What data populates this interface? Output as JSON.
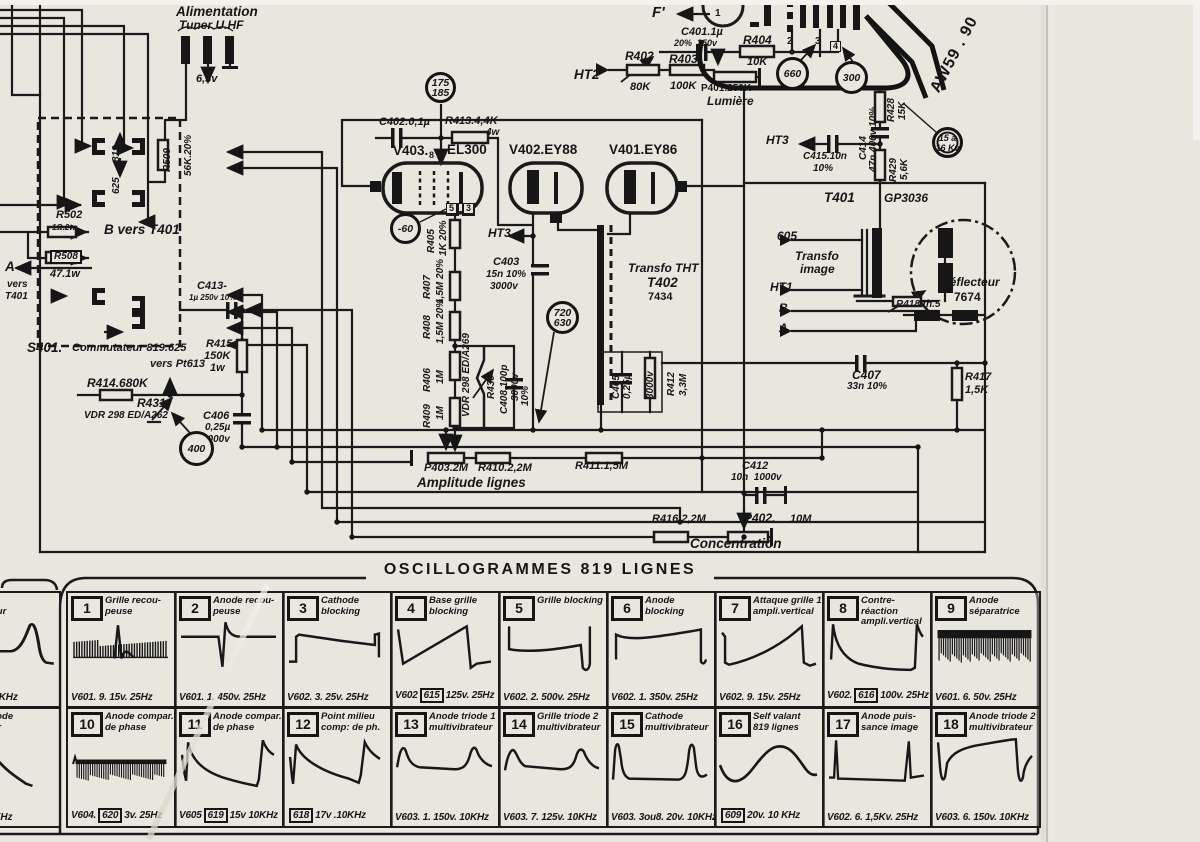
{
  "meta": {
    "paper_color": "#e9e6de",
    "ink_color": "#1a1a1a"
  },
  "schematic": {
    "labels": [
      {
        "t": "Alimentation",
        "x": 176,
        "y": 5,
        "c": "s13"
      },
      {
        "t": "Tuner U.HF",
        "x": 179,
        "y": 19,
        "c": "s12"
      },
      {
        "t": "6,3v",
        "x": 196,
        "y": 74,
        "c": "s11"
      },
      {
        "t": "R502",
        "x": 56,
        "y": 210,
        "c": "s11"
      },
      {
        "t": "1Ω.2w",
        "x": 52,
        "y": 224,
        "c": "s8"
      },
      {
        "t": "B vers T401",
        "x": 104,
        "y": 223,
        "c": "s13"
      },
      {
        "t": "R508",
        "x": 50,
        "y": 250,
        "c": "s10 boxed"
      },
      {
        "t": "47.1w",
        "x": 50,
        "y": 269,
        "c": "s11"
      },
      {
        "t": "A",
        "x": 5,
        "y": 260,
        "c": "s13"
      },
      {
        "t": "vers",
        "x": 7,
        "y": 280,
        "c": "s10"
      },
      {
        "t": "T401",
        "x": 5,
        "y": 292,
        "c": "s10"
      },
      {
        "t": "C413-",
        "x": 197,
        "y": 281,
        "c": "s11"
      },
      {
        "t": "1µ 250v 10%",
        "x": 189,
        "y": 294,
        "c": "s8"
      },
      {
        "t": "S401.",
        "x": 27,
        "y": 341,
        "c": "s13"
      },
      {
        "t": "Commutateur 819.625",
        "x": 72,
        "y": 343,
        "c": "s11"
      },
      {
        "t": "vers Pt613",
        "x": 150,
        "y": 359,
        "c": "s11"
      },
      {
        "t": "R414.680K",
        "x": 87,
        "y": 377,
        "c": "s12"
      },
      {
        "t": "R431",
        "x": 137,
        "y": 397,
        "c": "s12"
      },
      {
        "t": "VDR 298 ED/A262",
        "x": 84,
        "y": 411,
        "c": "s10"
      },
      {
        "t": "R415",
        "x": 206,
        "y": 339,
        "c": "s11"
      },
      {
        "t": "150K",
        "x": 204,
        "y": 351,
        "c": "s11"
      },
      {
        "t": "1w",
        "x": 210,
        "y": 363,
        "c": "s11"
      },
      {
        "t": "C406",
        "x": 203,
        "y": 411,
        "c": "s11"
      },
      {
        "t": "0,25µ",
        "x": 205,
        "y": 423,
        "c": "s10"
      },
      {
        "t": "3000v",
        "x": 202,
        "y": 435,
        "c": "s10"
      },
      {
        "t": "C402.0,1µ",
        "x": 379,
        "y": 117,
        "c": "s11"
      },
      {
        "t": "R413.4,4K",
        "x": 445,
        "y": 116,
        "c": "s11"
      },
      {
        "t": "4w",
        "x": 486,
        "y": 128,
        "c": "s10"
      },
      {
        "t": "V403.",
        "x": 393,
        "y": 144,
        "c": "s13 up"
      },
      {
        "t": "8",
        "x": 429,
        "y": 151,
        "c": "s9 up"
      },
      {
        "t": "EL300",
        "x": 447,
        "y": 143,
        "c": "s13 up"
      },
      {
        "t": "5",
        "x": 446,
        "y": 203,
        "c": "s9 pinbox"
      },
      {
        "t": "3",
        "x": 463,
        "y": 203,
        "c": "s9 pinbox"
      },
      {
        "t": "HT3",
        "x": 488,
        "y": 227,
        "c": "s12"
      },
      {
        "t": "C403",
        "x": 493,
        "y": 257,
        "c": "s11"
      },
      {
        "t": "15n 10%",
        "x": 486,
        "y": 270,
        "c": "s10"
      },
      {
        "t": "3000v",
        "x": 490,
        "y": 282,
        "c": "s10"
      },
      {
        "t": "V402.EY88",
        "x": 509,
        "y": 143,
        "c": "s13 up"
      },
      {
        "t": "V401.EY86",
        "x": 609,
        "y": 143,
        "c": "s13 up"
      },
      {
        "t": "Transfo THT",
        "x": 628,
        "y": 262,
        "c": "s12"
      },
      {
        "t": "T402",
        "x": 647,
        "y": 276,
        "c": "s13"
      },
      {
        "t": "7434",
        "x": 648,
        "y": 292,
        "c": "s11 up"
      },
      {
        "t": "C407",
        "x": 852,
        "y": 369,
        "c": "s12"
      },
      {
        "t": "33n 10%",
        "x": 847,
        "y": 382,
        "c": "s10"
      },
      {
        "t": "R417",
        "x": 965,
        "y": 372,
        "c": "s11"
      },
      {
        "t": "1,5K",
        "x": 965,
        "y": 385,
        "c": "s11"
      },
      {
        "t": "HT2",
        "x": 574,
        "y": 68,
        "c": "s13"
      },
      {
        "t": "R402",
        "x": 625,
        "y": 50,
        "c": "s12"
      },
      {
        "t": "80K",
        "x": 630,
        "y": 82,
        "c": "s11"
      },
      {
        "t": "R403",
        "x": 669,
        "y": 53,
        "c": "s12"
      },
      {
        "t": "100K",
        "x": 670,
        "y": 81,
        "c": "s11"
      },
      {
        "t": "P401.250K",
        "x": 701,
        "y": 84,
        "c": "s10 up"
      },
      {
        "t": "Lumière",
        "x": 707,
        "y": 95,
        "c": "s12"
      },
      {
        "t": "C401.1µ",
        "x": 681,
        "y": 27,
        "c": "s11"
      },
      {
        "t": "20%  250v",
        "x": 674,
        "y": 39,
        "c": "s9"
      },
      {
        "t": "R404",
        "x": 743,
        "y": 34,
        "c": "s12"
      },
      {
        "t": "10K",
        "x": 747,
        "y": 57,
        "c": "s11"
      },
      {
        "t": "F'",
        "x": 652,
        "y": 5,
        "c": "s14"
      },
      {
        "t": "1",
        "x": 715,
        "y": 9,
        "c": "s10 up"
      },
      {
        "t": "2",
        "x": 787,
        "y": 37,
        "c": "s10 up"
      },
      {
        "t": "3",
        "x": 815,
        "y": 37,
        "c": "s10 up"
      },
      {
        "t": "4",
        "x": 830,
        "y": 41,
        "c": "s9 pinbox"
      },
      {
        "t": "HT3",
        "x": 766,
        "y": 134,
        "c": "s12"
      },
      {
        "t": "C415.10n",
        "x": 803,
        "y": 152,
        "c": "s10"
      },
      {
        "t": "10%",
        "x": 813,
        "y": 164,
        "c": "s10"
      },
      {
        "t": "T401",
        "x": 824,
        "y": 191,
        "c": "s13"
      },
      {
        "t": "GP3036",
        "x": 884,
        "y": 192,
        "c": "s12"
      },
      {
        "t": "605",
        "x": 777,
        "y": 230,
        "c": "s12"
      },
      {
        "t": "Transfo",
        "x": 795,
        "y": 250,
        "c": "s12"
      },
      {
        "t": "image",
        "x": 800,
        "y": 263,
        "c": "s12"
      },
      {
        "t": "HT1",
        "x": 770,
        "y": 281,
        "c": "s12"
      },
      {
        "t": "B",
        "x": 779,
        "y": 302,
        "c": "s12"
      },
      {
        "t": "A",
        "x": 779,
        "y": 322,
        "c": "s12"
      },
      {
        "t": "Déflecteur",
        "x": 941,
        "y": 276,
        "c": "s12"
      },
      {
        "t": "7674",
        "x": 954,
        "y": 291,
        "c": "s12 up"
      },
      {
        "t": "R418 th.5",
        "x": 896,
        "y": 300,
        "c": "s10"
      },
      {
        "t": "P403.2M",
        "x": 424,
        "y": 463,
        "c": "s11"
      },
      {
        "t": "R410.2,2M",
        "x": 478,
        "y": 463,
        "c": "s11"
      },
      {
        "t": "R411.1,5M",
        "x": 575,
        "y": 461,
        "c": "s11"
      },
      {
        "t": "Amplitude lignes",
        "x": 417,
        "y": 476,
        "c": "s13"
      },
      {
        "t": "C412",
        "x": 742,
        "y": 461,
        "c": "s11"
      },
      {
        "t": "10n  1000v",
        "x": 731,
        "y": 473,
        "c": "s10"
      },
      {
        "t": "R416.2,2M",
        "x": 652,
        "y": 514,
        "c": "s11"
      },
      {
        "t": "P402.",
        "x": 744,
        "y": 512,
        "c": "s12"
      },
      {
        "t": "10M",
        "x": 790,
        "y": 514,
        "c": "s11"
      },
      {
        "t": "Concentration",
        "x": 690,
        "y": 537,
        "c": "s13"
      },
      {
        "t": "AW59 . 90",
        "x": 928,
        "y": 88,
        "c": "s15 awrot"
      }
    ],
    "vlabels": [
      {
        "t": "819",
        "x": 112,
        "y": 162
      },
      {
        "t": "625",
        "x": 112,
        "y": 194
      },
      {
        "t": "R509",
        "x": 163,
        "y": 172
      },
      {
        "t": "56K.20%",
        "x": 184,
        "y": 176
      },
      {
        "t": "R405",
        "x": 427,
        "y": 253
      },
      {
        "t": "1K 20%",
        "x": 439,
        "y": 256,
        "c": "s9"
      },
      {
        "t": "R407",
        "x": 423,
        "y": 299
      },
      {
        "t": "1,5M 20%",
        "x": 436,
        "y": 304,
        "c": "s9"
      },
      {
        "t": "R408",
        "x": 423,
        "y": 339
      },
      {
        "t": "1,5M 20%",
        "x": 436,
        "y": 344,
        "c": "s9"
      },
      {
        "t": "R406",
        "x": 423,
        "y": 392
      },
      {
        "t": "1M",
        "x": 436,
        "y": 384,
        "c": "s9"
      },
      {
        "t": "R409",
        "x": 423,
        "y": 428
      },
      {
        "t": "1M",
        "x": 436,
        "y": 420,
        "c": "s9"
      },
      {
        "t": "VDR 298 ED/A269",
        "x": 462,
        "y": 417,
        "c": "s9"
      },
      {
        "t": "R430",
        "x": 487,
        "y": 399
      },
      {
        "t": "C408.100p",
        "x": 500,
        "y": 414,
        "c": "s9"
      },
      {
        "t": "3000v",
        "x": 511,
        "y": 401,
        "c": "s8"
      },
      {
        "t": "10%",
        "x": 521,
        "y": 406,
        "c": "s8"
      },
      {
        "t": "C405",
        "x": 612,
        "y": 399,
        "c": "s9"
      },
      {
        "t": "0,25µ",
        "x": 623,
        "y": 399,
        "c": "s8"
      },
      {
        "t": "3000v",
        "x": 646,
        "y": 399,
        "c": "s8"
      },
      {
        "t": "R412",
        "x": 667,
        "y": 396
      },
      {
        "t": "3,3M",
        "x": 679,
        "y": 396
      },
      {
        "t": "R428",
        "x": 887,
        "y": 122
      },
      {
        "t": "15K",
        "x": 898,
        "y": 120
      },
      {
        "t": "C414",
        "x": 859,
        "y": 160,
        "c": "s9"
      },
      {
        "t": "47n 400v 10%",
        "x": 869,
        "y": 172,
        "c": "s8"
      },
      {
        "t": "R429",
        "x": 889,
        "y": 182
      },
      {
        "t": "5,6K",
        "x": 900,
        "y": 180
      }
    ],
    "circles": [
      {
        "lines": [
          "175",
          "185"
        ],
        "x": 441,
        "y": 88,
        "r": 16
      },
      {
        "lines": [
          "-60"
        ],
        "x": 406,
        "y": 229,
        "r": 16
      },
      {
        "lines": [
          "400"
        ],
        "x": 197,
        "y": 449,
        "r": 18
      },
      {
        "lines": [
          "720",
          "630"
        ],
        "x": 563,
        "y": 318,
        "r": 17
      },
      {
        "lines": [
          "660"
        ],
        "x": 793,
        "y": 74,
        "r": 17
      },
      {
        "lines": [
          "300"
        ],
        "x": 852,
        "y": 78,
        "r": 17
      },
      {
        "lines": [
          "15 à",
          "16 Kv"
        ],
        "x": 948,
        "y": 143,
        "r": 16,
        "dbl": true
      }
    ]
  },
  "osc": {
    "title": "OSCILLOGRAMMES 819 LIGNES",
    "cells": [
      {
        "n": "1",
        "t1": "Grille recou-",
        "t2": "peuse",
        "pre": "V601. 9. 15v. 25Hz",
        "box": "",
        "post": "",
        "w": "combSpike"
      },
      {
        "n": "2",
        "t1": "Anode recou-",
        "t2": "peuse",
        "pre": "V601. 1. 450v. 25Hz",
        "box": "",
        "post": "",
        "w": "biphasic"
      },
      {
        "n": "3",
        "t1": "Cathode",
        "t2": "blocking",
        "pre": "V602. 3. 25v. 25Hz",
        "box": "",
        "post": "",
        "w": "stepSag"
      },
      {
        "n": "4",
        "t1": "Base grille",
        "t2": "blocking",
        "pre": "V602",
        "box": "615",
        "post": "125v. 25Hz",
        "w": "saw"
      },
      {
        "n": "5",
        "t1": "Grille blocking",
        "t2": "",
        "pre": "V602. 2. 500v. 25Hz",
        "box": "",
        "post": "",
        "w": "rampNeg"
      },
      {
        "n": "6",
        "t1": "Anode blocking",
        "t2": "",
        "pre": "V602. 1. 350v. 25Hz",
        "box": "",
        "post": "",
        "w": "flatDip"
      },
      {
        "n": "7",
        "t1": "Attaque grille 1",
        "t2": "ampli.vertical",
        "pre": "V602. 9. 15v. 25Hz",
        "box": "",
        "post": "",
        "w": "concaveRise"
      },
      {
        "n": "8",
        "t1": "Contre-réaction",
        "t2": "ampli.vertical",
        "pre": "V602.",
        "box": "616",
        "post": "100v. 25Hz",
        "w": "expDecay"
      },
      {
        "n": "9",
        "t1": "Anode",
        "t2": "séparatrice",
        "pre": "V601. 6. 50v. 25Hz",
        "box": "",
        "post": "",
        "w": "combDense"
      },
      {
        "n": "10",
        "t1": "Anode compar.",
        "t2": "de phase",
        "pre": "V604.",
        "box": "620",
        "post": "3v. 25Hz",
        "w": "combBand"
      },
      {
        "n": "11",
        "t1": "Anode compar.",
        "t2": "de phase",
        "pre": "V605",
        "box": "619",
        "post": "15v 10KHz",
        "w": "spikeDecay"
      },
      {
        "n": "12",
        "t1": "Point milieu",
        "t2": "comp: de ph.",
        "pre": "",
        "box": "618",
        "post": "17v .10KHz",
        "w": "spikeDecay2"
      },
      {
        "n": "13",
        "t1": "Anode triode 1",
        "t2": "multivibrateur",
        "pre": "V603. 1. 150v. 10KHz",
        "box": "",
        "post": "",
        "w": "hump"
      },
      {
        "n": "14",
        "t1": "Grille triode 2",
        "t2": "multivibrateur",
        "pre": "V603. 7. 125v. 10KHz",
        "box": "",
        "post": "",
        "w": "hump2"
      },
      {
        "n": "15",
        "t1": "Cathode",
        "t2": "multivibrateur",
        "pre": "V603. 3ou8. 20v. 10KHz",
        "box": "",
        "post": "",
        "w": "sharpHump"
      },
      {
        "n": "16",
        "t1": "Self valant",
        "t2": "819 lignes",
        "pre": "",
        "box": "609",
        "post": "20v. 10 KHz",
        "w": "sine"
      },
      {
        "n": "17",
        "t1": "Anode puis-",
        "t2": "sance image",
        "pre": "V602. 6. 1,5Kv. 25Hz",
        "box": "",
        "post": "",
        "w": "needle"
      },
      {
        "n": "18",
        "t1": "Anode triode 2",
        "t2": "multivibrateur",
        "pre": "V603. 6. 150v. 10KHz",
        "box": "",
        "post": "",
        "w": "invPulse"
      }
    ],
    "partial": [
      {
        "t1": "hode",
        "t2": "ivibrateur",
        "cap": "8.17v.10KHz",
        "w": "humpRight"
      },
      {
        "t1": "sion anode",
        "t2": "parateur",
        "cap": "22v. 10KHz",
        "w": "spikeCut"
      }
    ]
  }
}
